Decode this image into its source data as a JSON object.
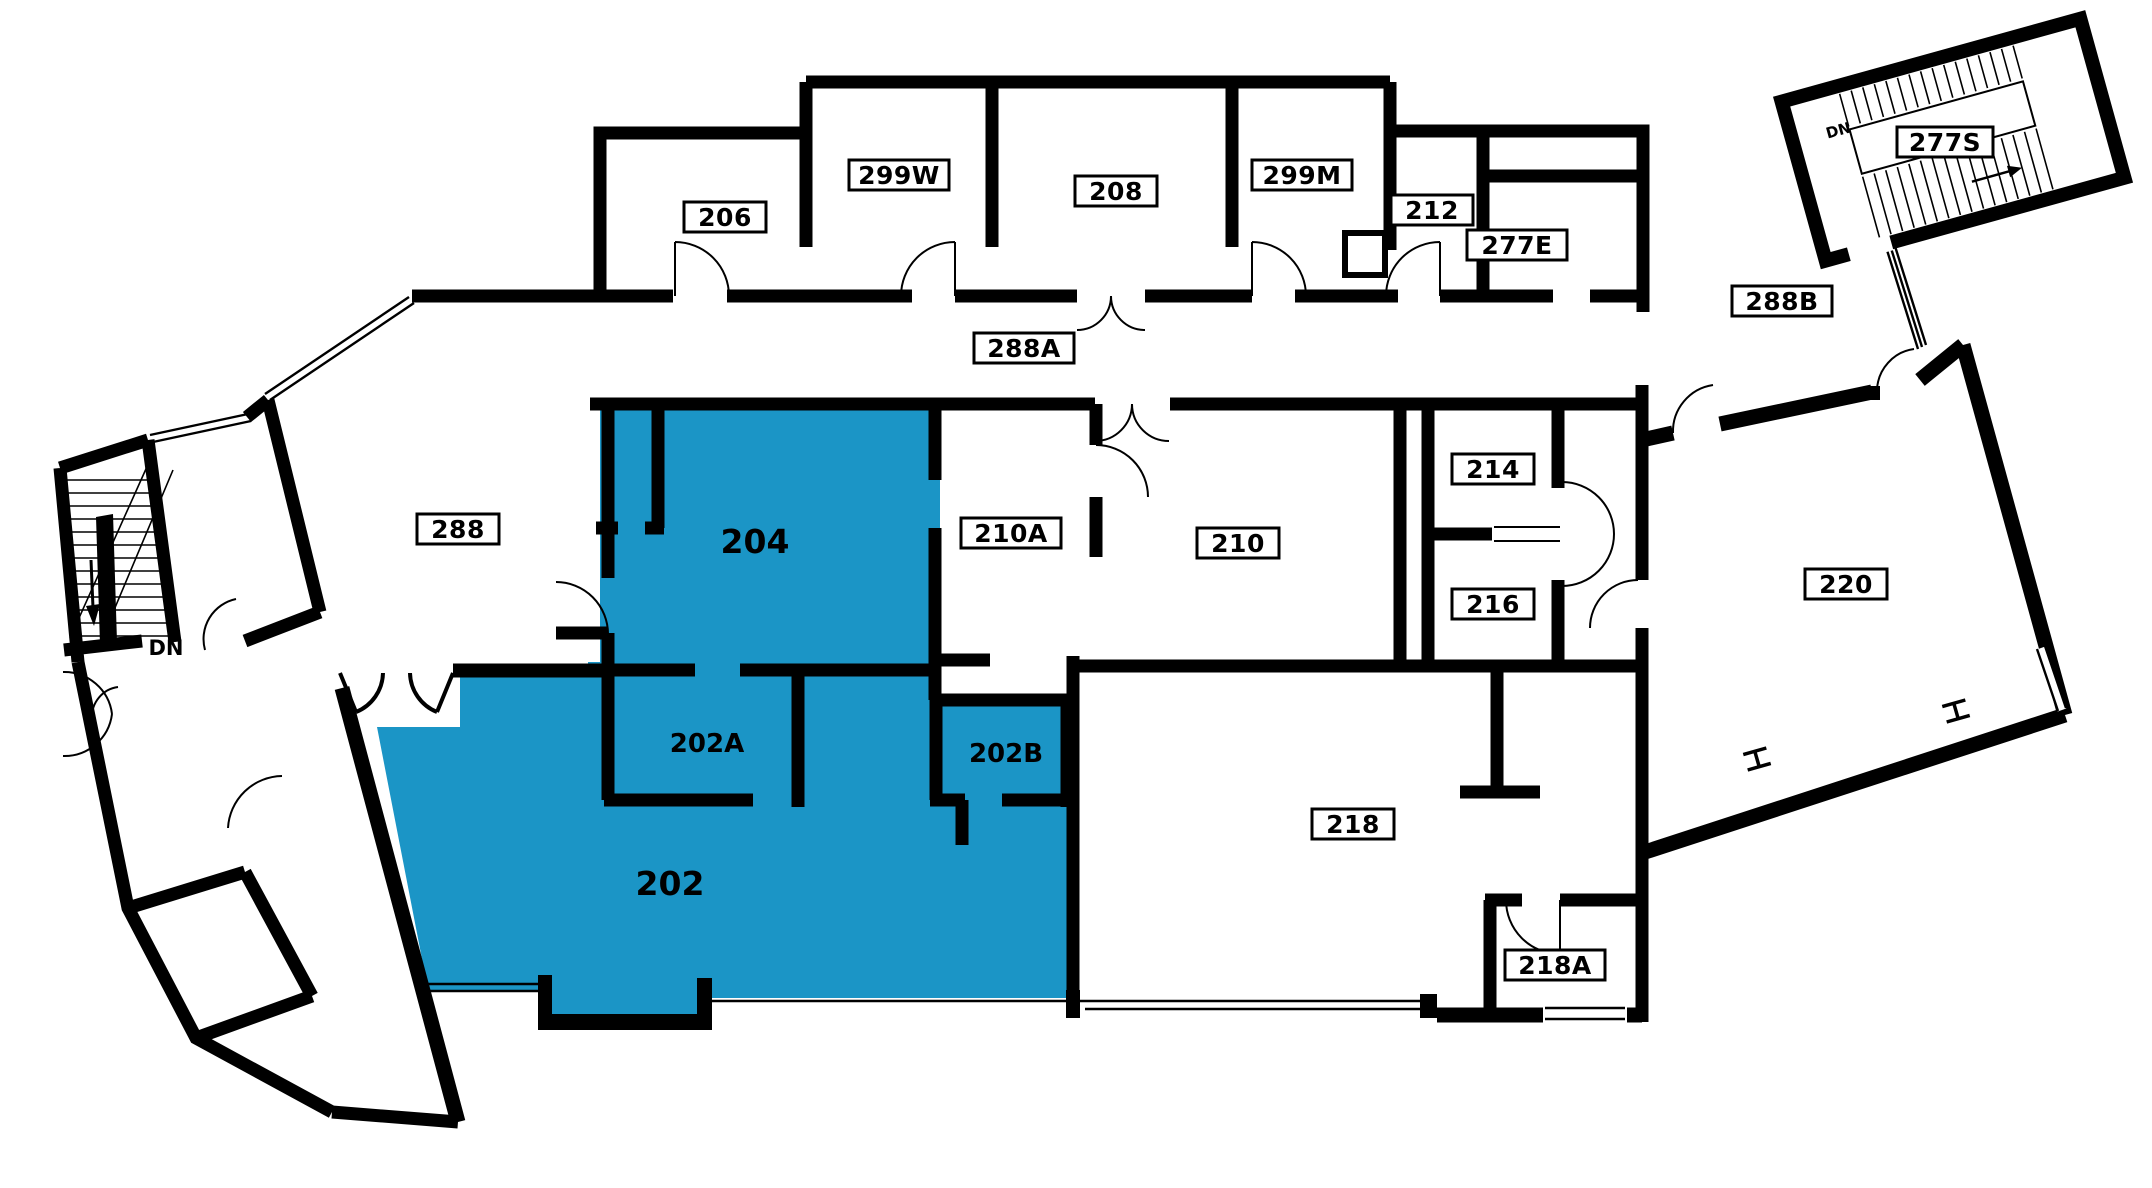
{
  "plan": {
    "type": "building-floor-plan",
    "highlight_color": "#1b95c6",
    "wall_color": "#000000",
    "highlighted_rooms": [
      "202",
      "202A",
      "202B",
      "204"
    ],
    "labels": {
      "r206": "206",
      "r299w": "299W",
      "r208": "208",
      "r299m": "299M",
      "r212": "212",
      "r277e": "277E",
      "r277s": "277S",
      "r288a": "288A",
      "r288b": "288B",
      "r288": "288",
      "r210a": "210A",
      "r210": "210",
      "r214": "214",
      "r216": "216",
      "r220": "220",
      "r218": "218",
      "r218a": "218A",
      "r204": "204",
      "r202": "202",
      "r202a": "202A",
      "r202b": "202B",
      "dn_left": "DN",
      "dn_right": "DN"
    }
  }
}
